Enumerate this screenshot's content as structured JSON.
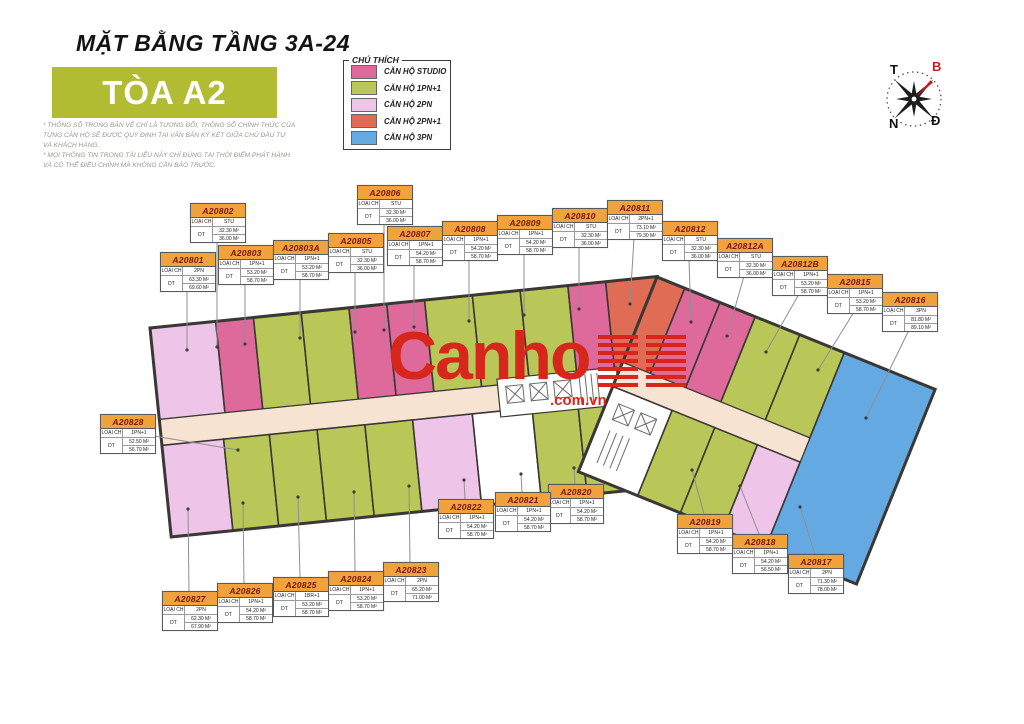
{
  "header": {
    "title": "MẶT BẰNG TẦNG 3A-24",
    "tower": "TÒA A2",
    "disclaimer_line1": "* THÔNG SỐ TRONG BẢN VẼ CHỈ LÀ TƯƠNG ĐỐI, THÔNG SỐ CHÍNH THỨC CỦA TỪNG CĂN HỘ SẼ ĐƯỢC QUY ĐỊNH TẠI VĂN BẢN KÝ KẾT GIỮA CHỦ ĐẦU TƯ VÀ KHÁCH HÀNG.",
    "disclaimer_line2": "* MỌI THÔNG TIN TRONG TÀI LIỆU NÀY CHỈ ĐÚNG TẠI THỜI ĐIỂM PHÁT HÀNH VÀ CÓ THỂ ĐIỀU CHỈNH MÀ KHÔNG CẦN BÁO TRƯỚC."
  },
  "legend": {
    "title": "CHÚ THÍCH",
    "items": [
      {
        "label": "CĂN HỘ STUDIO",
        "color": "#dd6a9a"
      },
      {
        "label": "CĂN HỘ 1PN+1",
        "color": "#b8c758"
      },
      {
        "label": "CĂN HỘ 2PN",
        "color": "#eec5e8"
      },
      {
        "label": "CĂN HỘ 2PN+1",
        "color": "#e06c55"
      },
      {
        "label": "CĂN HỘ 3PN",
        "color": "#64a9e1"
      }
    ]
  },
  "colors": {
    "studio": "#dd6a9a",
    "p1": "#b8c758",
    "p2": "#eec5e8",
    "p21": "#e06c55",
    "p3": "#64a9e1",
    "corridor": "#f7e3d2",
    "tower_box": "#b2bc32"
  },
  "compass": {
    "t": "T",
    "b": "B",
    "n": "N",
    "d": "Đ"
  },
  "watermark": {
    "brand": "Canho",
    "domain": ".com.vn"
  },
  "plan": {
    "field_labels": {
      "type": "LOẠI CH",
      "area": "DT"
    }
  },
  "units": [
    {
      "code": "A20801",
      "type": "2PN",
      "area1": "63.30 M²",
      "area2": "69.60 M²",
      "x": 160,
      "y": 252,
      "side": "bottom",
      "tx": 187,
      "ty": 350
    },
    {
      "code": "A20802",
      "type": "STU",
      "area1": "32.30 M²",
      "area2": "36.00 M²",
      "x": 190,
      "y": 203,
      "side": "bottom",
      "tx": 217,
      "ty": 347
    },
    {
      "code": "A20803",
      "type": "1PN+1",
      "area1": "53.20 M²",
      "area2": "58.70 M²",
      "x": 218,
      "y": 245,
      "side": "bottom",
      "tx": 245,
      "ty": 344
    },
    {
      "code": "A20803A",
      "type": "1PN+1",
      "area1": "53.20 M²",
      "area2": "58.70 M²",
      "x": 273,
      "y": 240,
      "side": "bottom",
      "tx": 300,
      "ty": 338
    },
    {
      "code": "A20805",
      "type": "STU",
      "area1": "32.30 M²",
      "area2": "36.00 M²",
      "x": 328,
      "y": 233,
      "side": "bottom",
      "tx": 355,
      "ty": 332
    },
    {
      "code": "A20806",
      "type": "STU",
      "area1": "32.30 M²",
      "area2": "36.00 M²",
      "x": 357,
      "y": 185,
      "side": "bottom",
      "tx": 384,
      "ty": 330
    },
    {
      "code": "A20807",
      "type": "1PN+1",
      "area1": "54.20 M²",
      "area2": "58.70 M²",
      "x": 387,
      "y": 226,
      "side": "bottom",
      "tx": 414,
      "ty": 327
    },
    {
      "code": "A20808",
      "type": "1PN+1",
      "area1": "54.20 M²",
      "area2": "58.70 M²",
      "x": 442,
      "y": 221,
      "side": "bottom",
      "tx": 469,
      "ty": 321
    },
    {
      "code": "A20809",
      "type": "1PN+1",
      "area1": "54.20 M²",
      "area2": "58.70 M²",
      "x": 497,
      "y": 215,
      "side": "bottom",
      "tx": 524,
      "ty": 315
    },
    {
      "code": "A20810",
      "type": "STU",
      "area1": "32.30 M²",
      "area2": "36.00 M²",
      "x": 552,
      "y": 208,
      "side": "bottom",
      "tx": 579,
      "ty": 309
    },
    {
      "code": "A20811",
      "type": "2PN+1",
      "area1": "73.10 M²",
      "area2": "79.30 M²",
      "x": 607,
      "y": 200,
      "side": "bottom",
      "tx": 630,
      "ty": 304
    },
    {
      "code": "A20812",
      "type": "STU",
      "area1": "32.30 M²",
      "area2": "36.00 M²",
      "x": 662,
      "y": 221,
      "side": "bottom",
      "tx": 691,
      "ty": 322
    },
    {
      "code": "A20812A",
      "type": "STU",
      "area1": "32.30 M²",
      "area2": "36.00 M²",
      "x": 717,
      "y": 238,
      "side": "bottom",
      "tx": 727,
      "ty": 336
    },
    {
      "code": "A20812B",
      "type": "1PN+1",
      "area1": "53.20 M²",
      "area2": "58.70 M²",
      "x": 772,
      "y": 256,
      "side": "bottom",
      "tx": 766,
      "ty": 352
    },
    {
      "code": "A20815",
      "type": "1PN+1",
      "area1": "53.20 M²",
      "area2": "58.70 M²",
      "x": 827,
      "y": 274,
      "side": "bottom",
      "tx": 818,
      "ty": 370
    },
    {
      "code": "A20816",
      "type": "3PN",
      "area1": "81.80 M²",
      "area2": "89.10 M²",
      "x": 882,
      "y": 292,
      "side": "bottom",
      "tx": 866,
      "ty": 418
    },
    {
      "code": "A20817",
      "type": "2PN",
      "area1": "71.30 M²",
      "area2": "78.00 M²",
      "x": 788,
      "y": 554,
      "side": "top",
      "tx": 800,
      "ty": 507
    },
    {
      "code": "A20818",
      "type": "1PN+1",
      "area1": "54.20 M²",
      "area2": "56.50 M²",
      "x": 732,
      "y": 534,
      "side": "top",
      "tx": 740,
      "ty": 486
    },
    {
      "code": "A20819",
      "type": "1PN+1",
      "area1": "54.20 M²",
      "area2": "58.70 M²",
      "x": 677,
      "y": 514,
      "side": "top",
      "tx": 692,
      "ty": 470
    },
    {
      "code": "A20820",
      "type": "1PN+1",
      "area1": "54.20 M²",
      "area2": "58.70 M²",
      "x": 548,
      "y": 484,
      "side": "top",
      "tx": 574,
      "ty": 468
    },
    {
      "code": "A20821",
      "type": "1PN+1",
      "area1": "54.20 M²",
      "area2": "58.70 M²",
      "x": 495,
      "y": 492,
      "side": "top",
      "tx": 521,
      "ty": 474
    },
    {
      "code": "A20822",
      "type": "1PN+1",
      "area1": "54.20 M²",
      "area2": "58.70 M²",
      "x": 438,
      "y": 499,
      "side": "top",
      "tx": 464,
      "ty": 480
    },
    {
      "code": "A20823",
      "type": "2PN",
      "area1": "65.20 M²",
      "area2": "71.00 M²",
      "x": 383,
      "y": 562,
      "side": "top",
      "tx": 409,
      "ty": 486
    },
    {
      "code": "A20824",
      "type": "1PN+1",
      "area1": "53.20 M²",
      "area2": "58.70 M²",
      "x": 328,
      "y": 571,
      "side": "top",
      "tx": 354,
      "ty": 492
    },
    {
      "code": "A20825",
      "type": "1BR+1",
      "area1": "53.20 M²",
      "area2": "58.70 M²",
      "x": 273,
      "y": 577,
      "side": "top",
      "tx": 298,
      "ty": 497
    },
    {
      "code": "A20826",
      "type": "1PN+1",
      "area1": "54.20 M²",
      "area2": "58.70 M²",
      "x": 217,
      "y": 583,
      "side": "top",
      "tx": 243,
      "ty": 503
    },
    {
      "code": "A20827",
      "type": "2PN",
      "area1": "62.30 M²",
      "area2": "67.90 M²",
      "x": 162,
      "y": 591,
      "side": "top",
      "tx": 188,
      "ty": 509
    },
    {
      "code": "A20828",
      "type": "1PN+1",
      "area1": "52.50 M²",
      "area2": "56.70 M²",
      "x": 100,
      "y": 414,
      "side": "right",
      "tx": 238,
      "ty": 450
    }
  ]
}
